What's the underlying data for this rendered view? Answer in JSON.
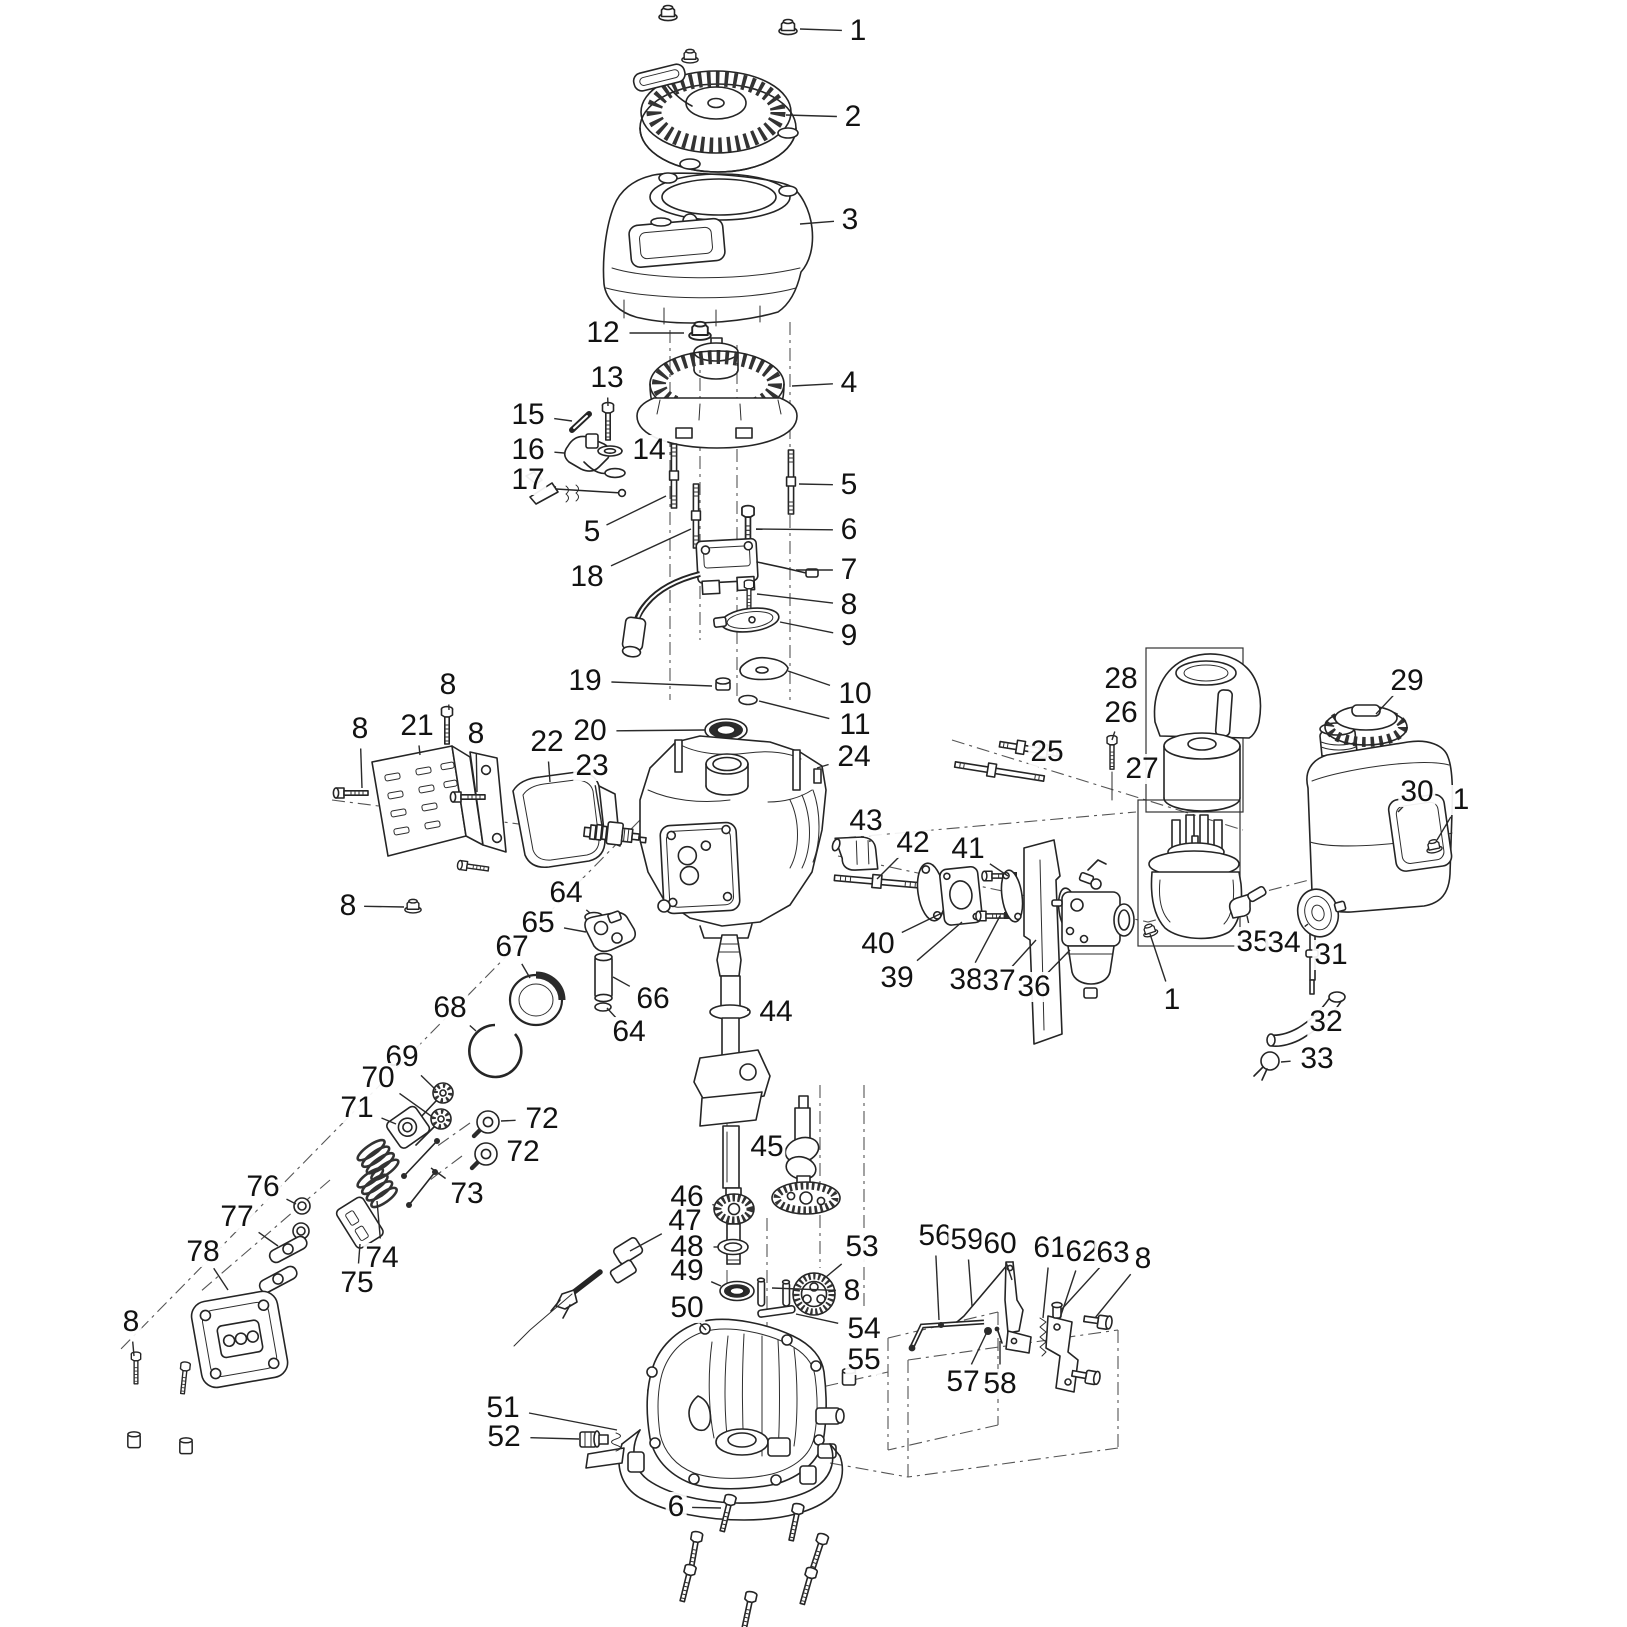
{
  "canvas": {
    "width": 1627,
    "height": 1627,
    "background": "#ffffff",
    "ink": "#252525",
    "callout_font_px": 30
  },
  "diagram": {
    "kind": "exploded-parts-diagram",
    "callouts": [
      {
        "n": "1",
        "x": 858,
        "y": 31,
        "lx": 800,
        "ly": 29
      },
      {
        "n": "2",
        "x": 853,
        "y": 117,
        "lx": 786,
        "ly": 115
      },
      {
        "n": "3",
        "x": 850,
        "y": 220,
        "lx": 800,
        "ly": 224
      },
      {
        "n": "12",
        "x": 603,
        "y": 333,
        "lx": 684,
        "ly": 333
      },
      {
        "n": "13",
        "x": 607,
        "y": 378,
        "lx": 608,
        "ly": 406
      },
      {
        "n": "4",
        "x": 849,
        "y": 383,
        "lx": 792,
        "ly": 386
      },
      {
        "n": "15",
        "x": 528,
        "y": 415,
        "lx": 572,
        "ly": 421
      },
      {
        "n": "16",
        "x": 528,
        "y": 450,
        "lx": 564,
        "ly": 453
      },
      {
        "n": "14",
        "x": 649,
        "y": 450,
        "lx": 621,
        "ly": 451
      },
      {
        "n": "17",
        "x": 528,
        "y": 480,
        "lx": 556,
        "ly": 487
      },
      {
        "n": "5",
        "x": 849,
        "y": 485,
        "lx": 799,
        "ly": 484
      },
      {
        "n": "6",
        "x": 849,
        "y": 530,
        "lx": 756,
        "ly": 529
      },
      {
        "n": "5",
        "x": 592,
        "y": 532,
        "lx": 666,
        "ly": 496
      },
      {
        "n": "7",
        "x": 849,
        "y": 570,
        "lx": 796,
        "ly": 570
      },
      {
        "n": "18",
        "x": 587,
        "y": 577,
        "lx": 691,
        "ly": 529
      },
      {
        "n": "8",
        "x": 849,
        "y": 605,
        "lx": 757,
        "ly": 594
      },
      {
        "n": "9",
        "x": 849,
        "y": 636,
        "lx": 780,
        "ly": 622
      },
      {
        "n": "19",
        "x": 585,
        "y": 681,
        "lx": 712,
        "ly": 686
      },
      {
        "n": "10",
        "x": 855,
        "y": 694,
        "lx": 788,
        "ly": 671
      },
      {
        "n": "11",
        "x": 855,
        "y": 725,
        "lx": 759,
        "ly": 701
      },
      {
        "n": "20",
        "x": 590,
        "y": 731,
        "lx": 705,
        "ly": 730
      },
      {
        "n": "24",
        "x": 854,
        "y": 757,
        "lx": 817,
        "ly": 768
      },
      {
        "n": "8",
        "x": 448,
        "y": 685,
        "lx": 449,
        "ly": 710
      },
      {
        "n": "21",
        "x": 417,
        "y": 726,
        "lx": 420,
        "ly": 755
      },
      {
        "n": "8",
        "x": 360,
        "y": 729,
        "lx": 362,
        "ly": 788
      },
      {
        "n": "8",
        "x": 476,
        "y": 734,
        "lx": 477,
        "ly": 792
      },
      {
        "n": "22",
        "x": 547,
        "y": 742,
        "lx": 550,
        "ly": 782
      },
      {
        "n": "23",
        "x": 592,
        "y": 766,
        "lx": 602,
        "ly": 826
      },
      {
        "n": "28",
        "x": 1121,
        "y": 679,
        "lx": 1146,
        "ly": 688
      },
      {
        "n": "26",
        "x": 1121,
        "y": 713,
        "lx": 1112,
        "ly": 740
      },
      {
        "n": "29",
        "x": 1407,
        "y": 681,
        "lx": 1376,
        "ly": 714
      },
      {
        "n": "25",
        "x": 1047,
        "y": 752,
        "lx": 1022,
        "ly": 760
      },
      {
        "n": "27",
        "x": 1142,
        "y": 769,
        "lx": 1166,
        "ly": 778
      },
      {
        "n": "30",
        "x": 1417,
        "y": 792,
        "lx": 1398,
        "ly": 812
      },
      {
        "n": "1",
        "x": 1461,
        "y": 800,
        "lx": 1437,
        "ly": 840
      },
      {
        "n": "43",
        "x": 866,
        "y": 821,
        "lx": 870,
        "ly": 842
      },
      {
        "n": "42",
        "x": 913,
        "y": 843,
        "lx": 877,
        "ly": 879
      },
      {
        "n": "41",
        "x": 968,
        "y": 849,
        "lx": 1008,
        "ly": 876
      },
      {
        "n": "40",
        "x": 878,
        "y": 944,
        "lx": 944,
        "ly": 912
      },
      {
        "n": "39",
        "x": 897,
        "y": 978,
        "lx": 962,
        "ly": 922
      },
      {
        "n": "38",
        "x": 966,
        "y": 980,
        "lx": 1000,
        "ly": 916
      },
      {
        "n": "37",
        "x": 999,
        "y": 981,
        "lx": 1036,
        "ly": 940
      },
      {
        "n": "36",
        "x": 1034,
        "y": 987,
        "lx": 1070,
        "ly": 950
      },
      {
        "n": "1",
        "x": 1172,
        "y": 1000,
        "lx": 1150,
        "ly": 934
      },
      {
        "n": "35",
        "x": 1253,
        "y": 942,
        "lx": 1247,
        "ly": 916
      },
      {
        "n": "34",
        "x": 1284,
        "y": 943,
        "lx": 1308,
        "ly": 924
      },
      {
        "n": "31",
        "x": 1331,
        "y": 955,
        "lx": 1316,
        "ly": 952
      },
      {
        "n": "32",
        "x": 1326,
        "y": 1022,
        "lx": 1304,
        "ly": 1022
      },
      {
        "n": "33",
        "x": 1317,
        "y": 1059,
        "lx": 1281,
        "ly": 1062
      },
      {
        "n": "8",
        "x": 348,
        "y": 906,
        "lx": 404,
        "ly": 907
      },
      {
        "n": "64",
        "x": 566,
        "y": 893,
        "lx": 590,
        "ly": 913
      },
      {
        "n": "65",
        "x": 538,
        "y": 923,
        "lx": 586,
        "ly": 932
      },
      {
        "n": "67",
        "x": 512,
        "y": 947,
        "lx": 530,
        "ly": 978
      },
      {
        "n": "68",
        "x": 450,
        "y": 1008,
        "lx": 476,
        "ly": 1031
      },
      {
        "n": "66",
        "x": 653,
        "y": 999,
        "lx": 613,
        "ly": 977
      },
      {
        "n": "64",
        "x": 629,
        "y": 1032,
        "lx": 607,
        "ly": 1008
      },
      {
        "n": "44",
        "x": 776,
        "y": 1012,
        "lx": 747,
        "ly": 1010
      },
      {
        "n": "69",
        "x": 402,
        "y": 1057,
        "lx": 436,
        "ly": 1090
      },
      {
        "n": "70",
        "x": 378,
        "y": 1078,
        "lx": 431,
        "ly": 1116
      },
      {
        "n": "71",
        "x": 357,
        "y": 1108,
        "lx": 396,
        "ly": 1124
      },
      {
        "n": "72",
        "x": 542,
        "y": 1119,
        "lx": 501,
        "ly": 1121
      },
      {
        "n": "72",
        "x": 523,
        "y": 1152,
        "lx": 499,
        "ly": 1153
      },
      {
        "n": "73",
        "x": 467,
        "y": 1194,
        "lx": 431,
        "ly": 1168
      },
      {
        "n": "45",
        "x": 767,
        "y": 1147,
        "lx": 792,
        "ly": 1152
      },
      {
        "n": "46",
        "x": 687,
        "y": 1197,
        "lx": 714,
        "ly": 1205
      },
      {
        "n": "47",
        "x": 685,
        "y": 1221,
        "lx": 630,
        "ly": 1251
      },
      {
        "n": "48",
        "x": 687,
        "y": 1247,
        "lx": 718,
        "ly": 1247
      },
      {
        "n": "49",
        "x": 687,
        "y": 1271,
        "lx": 721,
        "ly": 1286
      },
      {
        "n": "50",
        "x": 687,
        "y": 1308,
        "lx": 706,
        "ly": 1330
      },
      {
        "n": "53",
        "x": 862,
        "y": 1247,
        "lx": 826,
        "ly": 1277
      },
      {
        "n": "8",
        "x": 852,
        "y": 1291,
        "lx": 772,
        "ly": 1288
      },
      {
        "n": "54",
        "x": 864,
        "y": 1329,
        "lx": 796,
        "ly": 1314
      },
      {
        "n": "55",
        "x": 864,
        "y": 1360,
        "lx": 853,
        "ly": 1373
      },
      {
        "n": "56",
        "x": 935,
        "y": 1236,
        "lx": 939,
        "ly": 1320
      },
      {
        "n": "59",
        "x": 967,
        "y": 1240,
        "lx": 972,
        "ly": 1306
      },
      {
        "n": "60",
        "x": 1000,
        "y": 1244,
        "lx": 1012,
        "ly": 1280
      },
      {
        "n": "61",
        "x": 1050,
        "y": 1248,
        "lx": 1043,
        "ly": 1318
      },
      {
        "n": "62",
        "x": 1082,
        "y": 1252,
        "lx": 1060,
        "ly": 1318
      },
      {
        "n": "63",
        "x": 1113,
        "y": 1253,
        "lx": 1061,
        "ly": 1310
      },
      {
        "n": "8",
        "x": 1143,
        "y": 1259,
        "lx": 1095,
        "ly": 1318
      },
      {
        "n": "57",
        "x": 963,
        "y": 1382,
        "lx": 986,
        "ly": 1334
      },
      {
        "n": "58",
        "x": 1000,
        "y": 1384,
        "lx": 1000,
        "ly": 1341
      },
      {
        "n": "74",
        "x": 382,
        "y": 1258,
        "lx": 377,
        "ly": 1201
      },
      {
        "n": "75",
        "x": 357,
        "y": 1283,
        "lx": 360,
        "ly": 1244
      },
      {
        "n": "76",
        "x": 263,
        "y": 1187,
        "lx": 296,
        "ly": 1204
      },
      {
        "n": "77",
        "x": 237,
        "y": 1217,
        "lx": 278,
        "ly": 1246
      },
      {
        "n": "78",
        "x": 203,
        "y": 1252,
        "lx": 228,
        "ly": 1290
      },
      {
        "n": "8",
        "x": 131,
        "y": 1322,
        "lx": 134,
        "ly": 1356
      },
      {
        "n": "51",
        "x": 503,
        "y": 1408,
        "lx": 617,
        "ly": 1430
      },
      {
        "n": "52",
        "x": 504,
        "y": 1437,
        "lx": 579,
        "ly": 1439
      },
      {
        "n": "6",
        "x": 676,
        "y": 1507,
        "lx": 721,
        "ly": 1508
      }
    ]
  }
}
